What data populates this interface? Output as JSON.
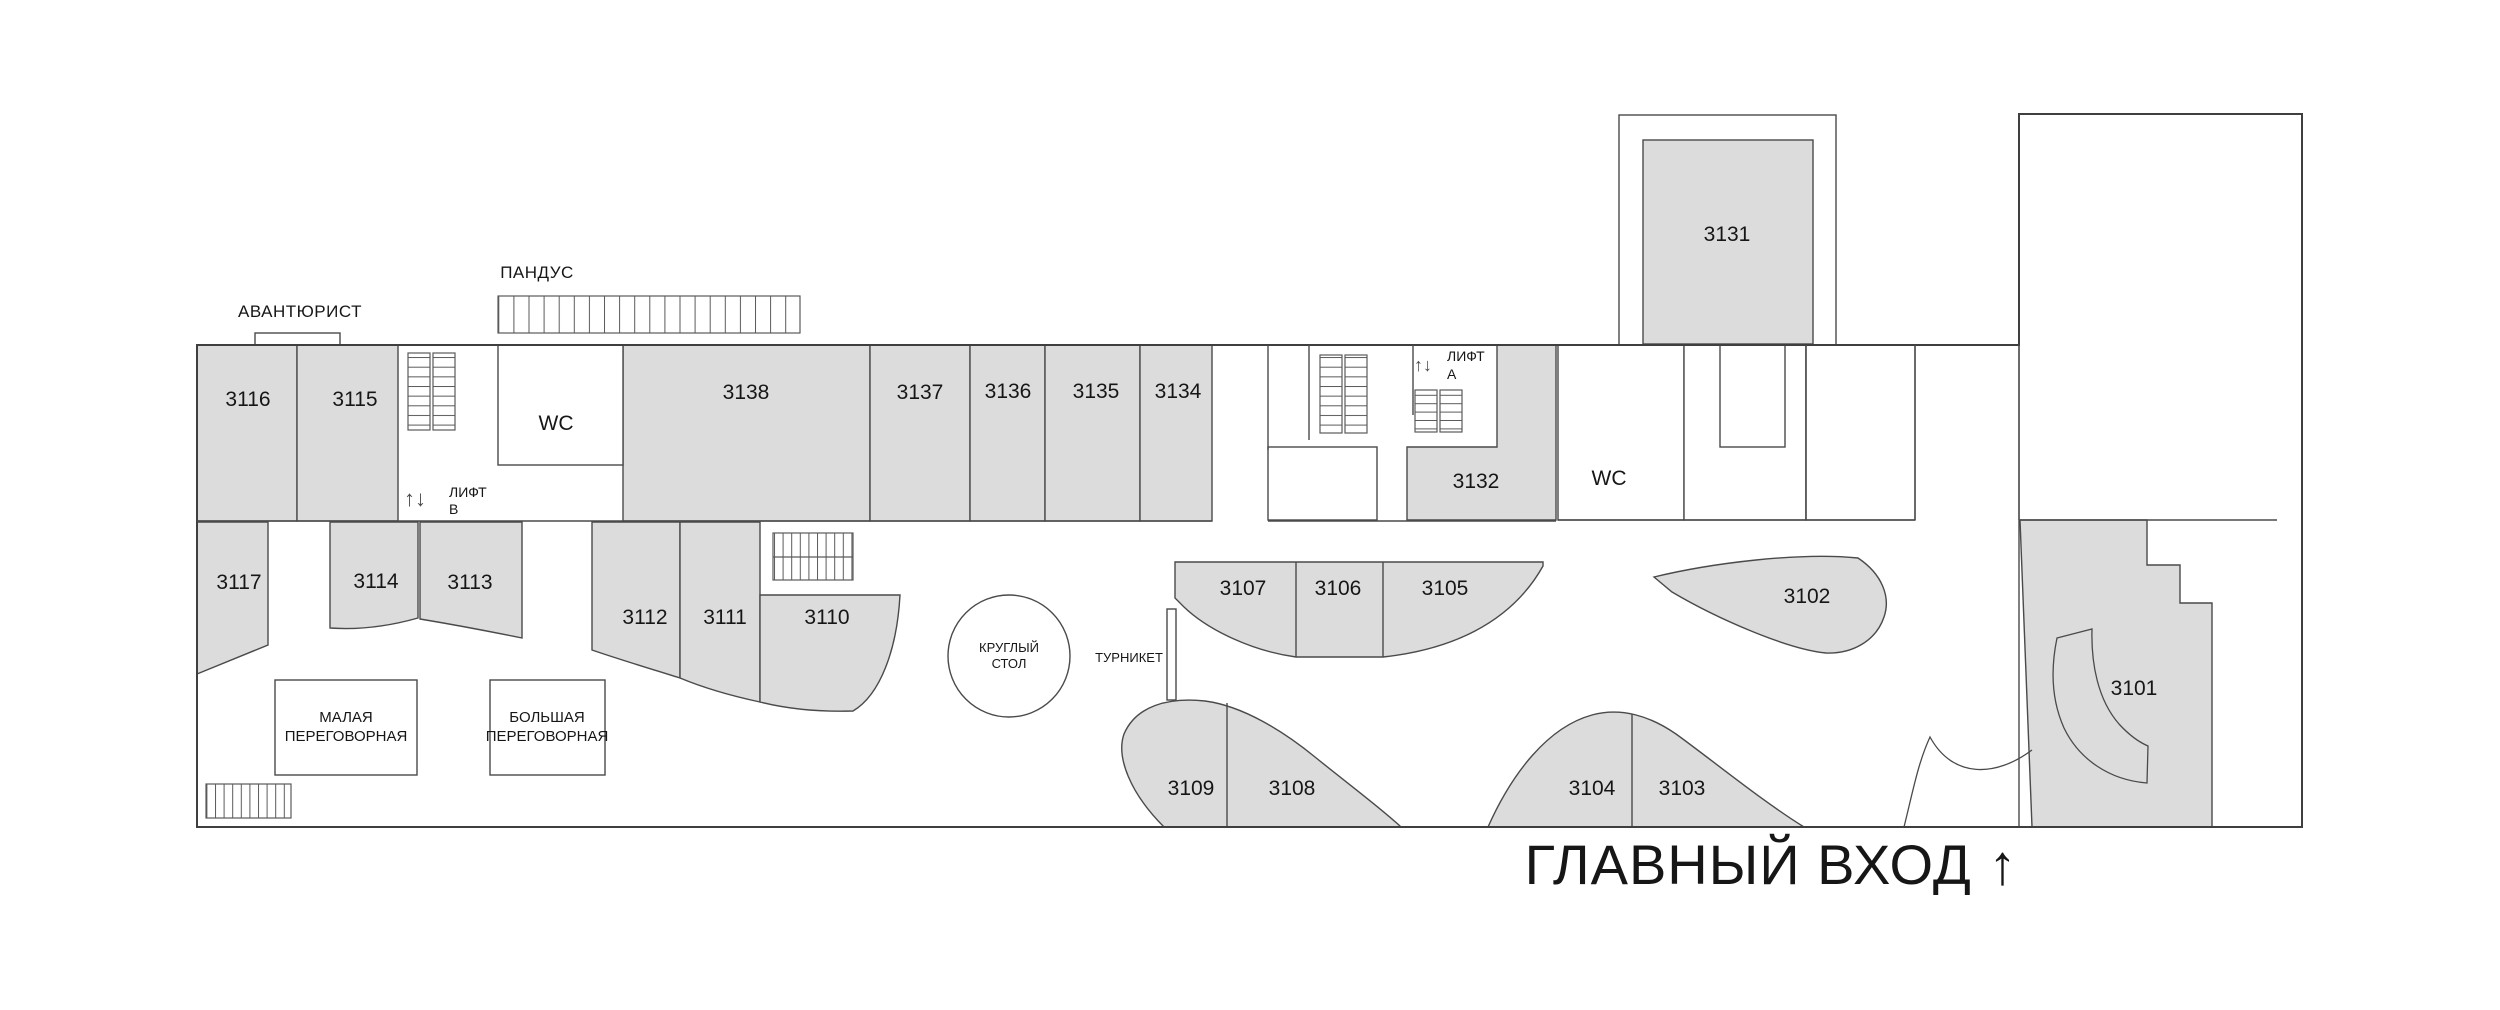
{
  "meta": {
    "type": "floor-plan",
    "floor_prefix": "31",
    "colors": {
      "room_fill": "#dcdcdc",
      "wall": "#3f3f3f",
      "background": "#ffffff",
      "text": "#161616"
    }
  },
  "labels": {
    "tenant": "АВАНТЮРИСТ",
    "ramp": "ПАНДУС",
    "lift_arrows": "↑↓",
    "lift_b_line1": "ЛИФТ",
    "lift_b_line2": "В",
    "lift_a_line1": "ЛИФТ",
    "lift_a_line2": "А",
    "wc_west": "WC",
    "wc_east": "WC",
    "small_meeting_line1": "МАЛАЯ",
    "small_meeting_line2": "ПЕРЕГОВОРНАЯ",
    "big_meeting_line1": "БОЛЬШАЯ",
    "big_meeting_line2": "ПЕРЕГОВОРНАЯ",
    "round_table_line1": "КРУГЛЫЙ",
    "round_table_line2": "СТОЛ",
    "turnstile": "ТУРНИКЕТ",
    "main_entrance": "ГЛАВНЫЙ ВХОД ↑"
  },
  "rooms": [
    {
      "number": "3116"
    },
    {
      "number": "3115"
    },
    {
      "number": "3117"
    },
    {
      "number": "3114"
    },
    {
      "number": "3113"
    },
    {
      "number": "3112"
    },
    {
      "number": "3111"
    },
    {
      "number": "3110"
    },
    {
      "number": "3138"
    },
    {
      "number": "3137"
    },
    {
      "number": "3136"
    },
    {
      "number": "3135"
    },
    {
      "number": "3134"
    },
    {
      "number": "3132"
    },
    {
      "number": "3131"
    },
    {
      "number": "3107"
    },
    {
      "number": "3106"
    },
    {
      "number": "3105"
    },
    {
      "number": "3109"
    },
    {
      "number": "3108"
    },
    {
      "number": "3104"
    },
    {
      "number": "3103"
    },
    {
      "number": "3102"
    },
    {
      "number": "3101"
    }
  ]
}
